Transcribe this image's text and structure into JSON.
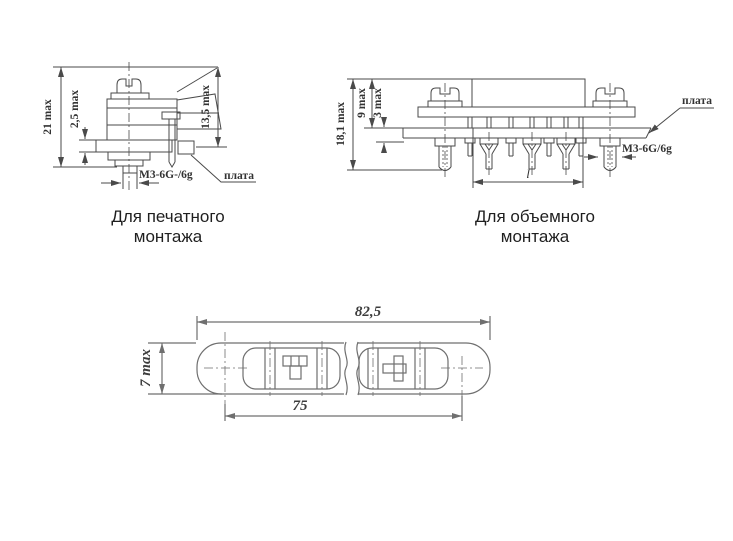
{
  "figures": {
    "printed": {
      "caption": "Для печатного монтажа",
      "dim_total_height": "21 max",
      "dim_flange": "2,5 max",
      "dim_right_height": "13,5 max",
      "thread_label": "М3-6G-/6g",
      "board_label": "плата"
    },
    "volume": {
      "caption": "Для объемного монтажа",
      "dim_total_height": "18,1 max",
      "dim_upper": "9 max",
      "dim_lower": "3 max",
      "dim_length": "l",
      "thread_label": "М3-6G/6g",
      "board_label": "плата"
    },
    "plan": {
      "dim_overall": "82,5",
      "dim_spacing": "75",
      "dim_height": "7 max"
    }
  },
  "colors": {
    "background": "#ffffff",
    "drawing_line": "#4a4a4a",
    "plan_line": "#6f6f6f",
    "label_text": "#333333",
    "caption_text": "#1f1f1f"
  }
}
